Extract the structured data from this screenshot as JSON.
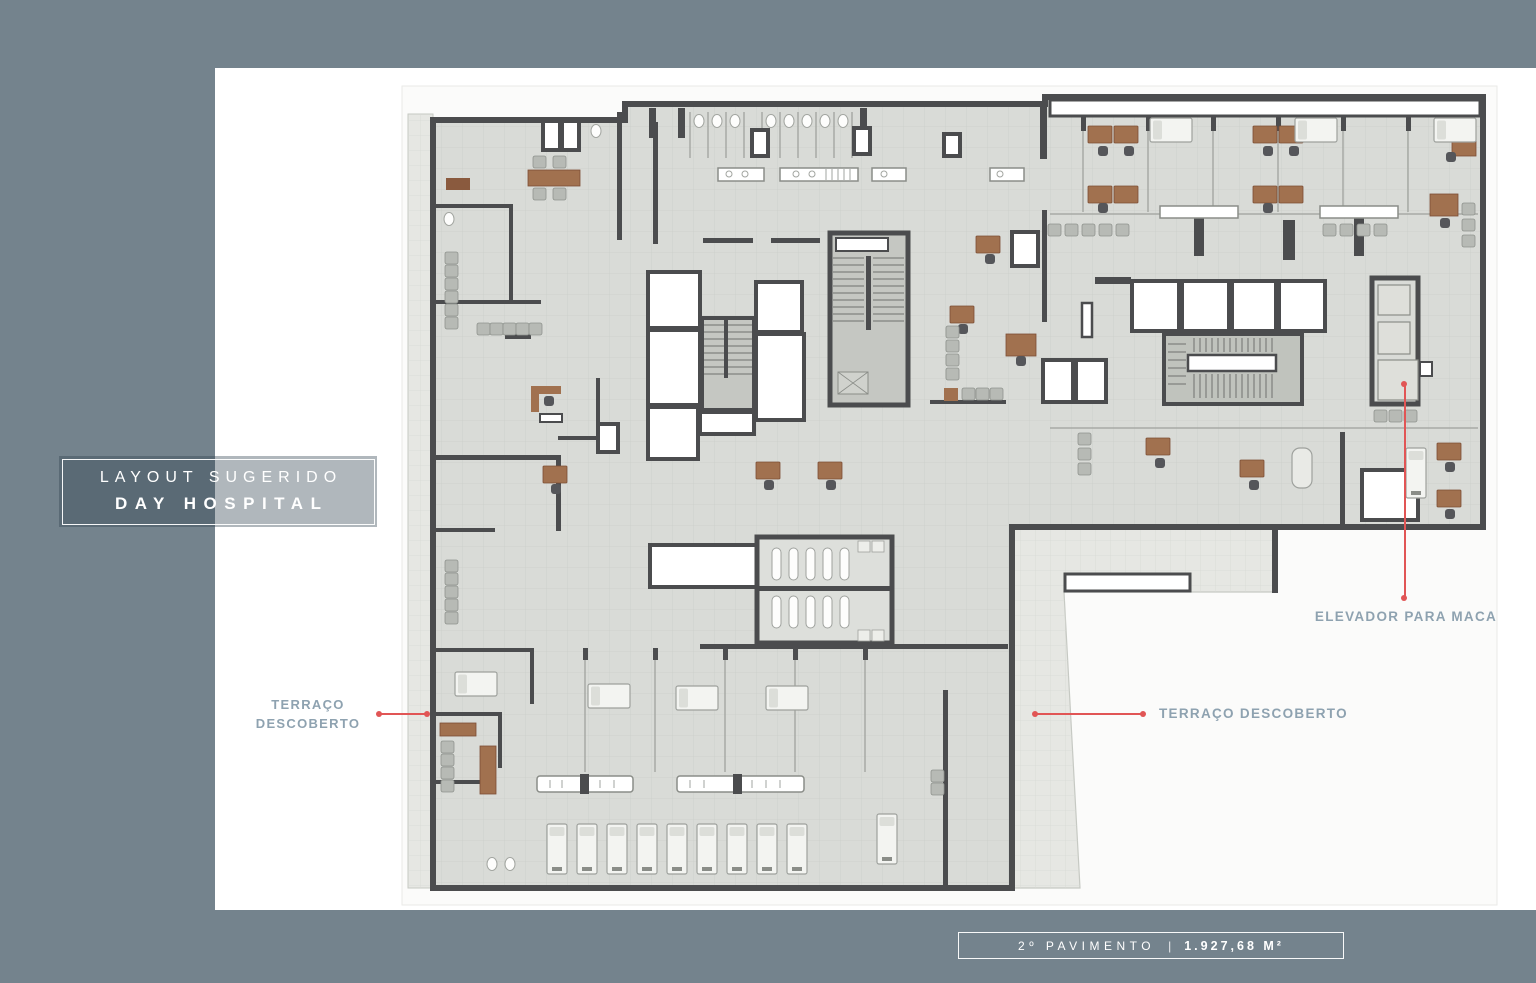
{
  "title_box": {
    "line1": "LAYOUT SUGERIDO",
    "line2": "DAY HOSPITAL",
    "overlay_color": "rgba(47,66,80,0.38)",
    "border_color": "#FFFFFF",
    "text_color": "#FFFFFF"
  },
  "annotations": {
    "text_color": "#8EA2B0",
    "leader_color": "#E15555",
    "terrace_left": {
      "line1": "TERRAÇO",
      "line2": "DESCOBERTO"
    },
    "terrace_right": {
      "label": "TERRAÇO DESCOBERTO"
    },
    "elevator": {
      "label": "ELEVADOR PARA MACA"
    }
  },
  "footer": {
    "floor_label": "2º PAVIMENTO",
    "separator": "|",
    "area_label": "1.927,68 M²",
    "text_color": "#FFFFFF"
  },
  "frame": {
    "color": "#74838D"
  },
  "plan_colors": {
    "wall": "#4B4C4E",
    "floor": "#D9DBD7",
    "terrace": "#E6E7E3",
    "white_room": "#FFFFFF",
    "stair": "#C5C7C2",
    "furniture_wood": "#A1714F",
    "seat": "#B7BAB5",
    "bed": "#F3F4F1"
  }
}
